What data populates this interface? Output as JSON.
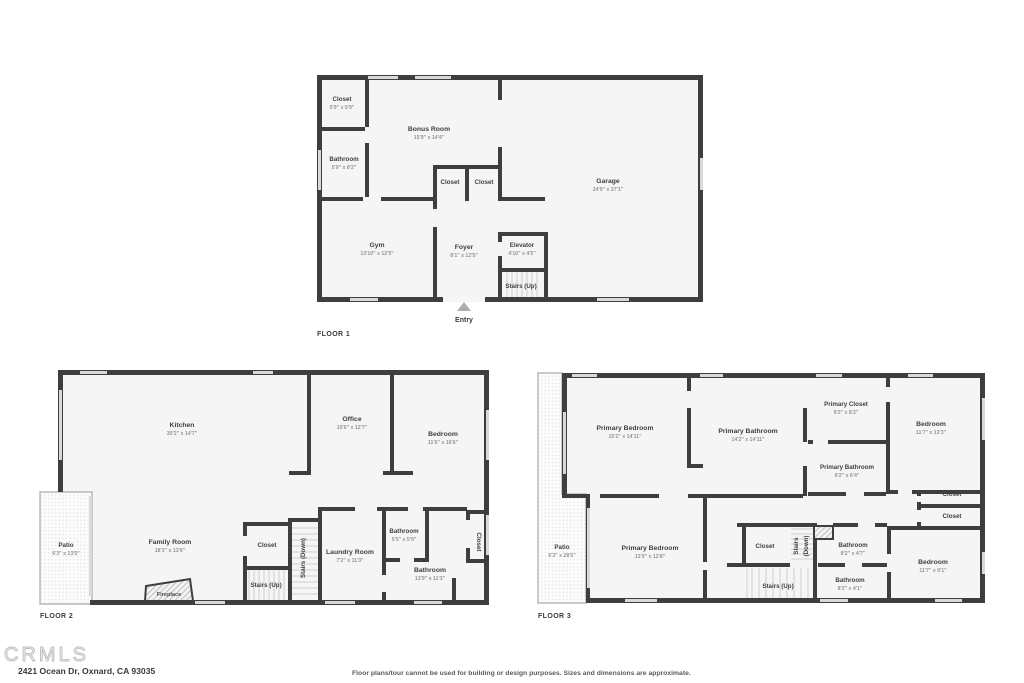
{
  "floors": [
    {
      "label": "FLOOR 1",
      "entry": "Entry",
      "rooms": [
        {
          "name": "Closet",
          "dims": "5'9\" x 5'9\""
        },
        {
          "name": "Bathroom",
          "dims": "5'9\" x 8'2\""
        },
        {
          "name": "Bonus Room",
          "dims": "15'9\" x 14'4\""
        },
        {
          "name": "Closet"
        },
        {
          "name": "Closet"
        },
        {
          "name": "Garage",
          "dims": "24'9\" x 27'1\""
        },
        {
          "name": "Gym",
          "dims": "13'10\" x 12'5\""
        },
        {
          "name": "Foyer",
          "dims": "8'1\" x 12'5\""
        },
        {
          "name": "Elevator",
          "dims": "4'10\" x 4'5\""
        },
        {
          "name": "Stairs (Up)"
        }
      ]
    },
    {
      "label": "FLOOR 2",
      "rooms": [
        {
          "name": "Kitchen",
          "dims": "30'2\" x 14'7\""
        },
        {
          "name": "Office",
          "dims": "10'6\" x 12'7\""
        },
        {
          "name": "Bedroom",
          "dims": "11'6\" x 16'6\""
        },
        {
          "name": "Patio",
          "dims": "6'3\" x 13'5\""
        },
        {
          "name": "Family Room",
          "dims": "18'3\" x 13'6\""
        },
        {
          "name": "Closet"
        },
        {
          "name": "Stairs (Down)"
        },
        {
          "name": "Stairs (Up)"
        },
        {
          "name": "Laundry Room",
          "dims": "7'2\" x 11'3\""
        },
        {
          "name": "Bathroom",
          "dims": "5'5\" x 5'9\""
        },
        {
          "name": "Bathroom",
          "dims": "13'9\" x 11'3\""
        },
        {
          "name": "Closet"
        },
        {
          "name": "Fireplace"
        }
      ]
    },
    {
      "label": "FLOOR 3",
      "rooms": [
        {
          "name": "Primary Bedroom",
          "dims": "15'2\" x 14'11\""
        },
        {
          "name": "Primary Bathroom",
          "dims": "14'2\" x 14'11\""
        },
        {
          "name": "Primary Closet",
          "dims": "9'2\" x 8'2\""
        },
        {
          "name": "Bedroom",
          "dims": "11'7\" x 13'3\""
        },
        {
          "name": "Primary Bathroom",
          "dims": "9'2\" x 6'4\""
        },
        {
          "name": "Closet"
        },
        {
          "name": "Closet"
        },
        {
          "name": "Patio",
          "dims": "6'3\" x 28'5\""
        },
        {
          "name": "Primary Bedroom",
          "dims": "13'9\" x 12'8\""
        },
        {
          "name": "Closet"
        },
        {
          "name": "Stairs",
          "name2": "(Down)"
        },
        {
          "name": "Bathroom",
          "dims": "8'2\" x 4'7\""
        },
        {
          "name": "Bathroom",
          "dims": "8'2\" x 4'1\""
        },
        {
          "name": "Stairs (Up)"
        },
        {
          "name": "Bedroom",
          "dims": "11'7\" x 9'1\""
        }
      ]
    }
  ],
  "footer": {
    "logo": "CRMLS",
    "address": "2421 Ocean Dr, Oxnard, CA 93035",
    "disclaimer": "Floor plans/tour cannot be used for building or design purposes. Sizes and dimensions are approximate."
  }
}
